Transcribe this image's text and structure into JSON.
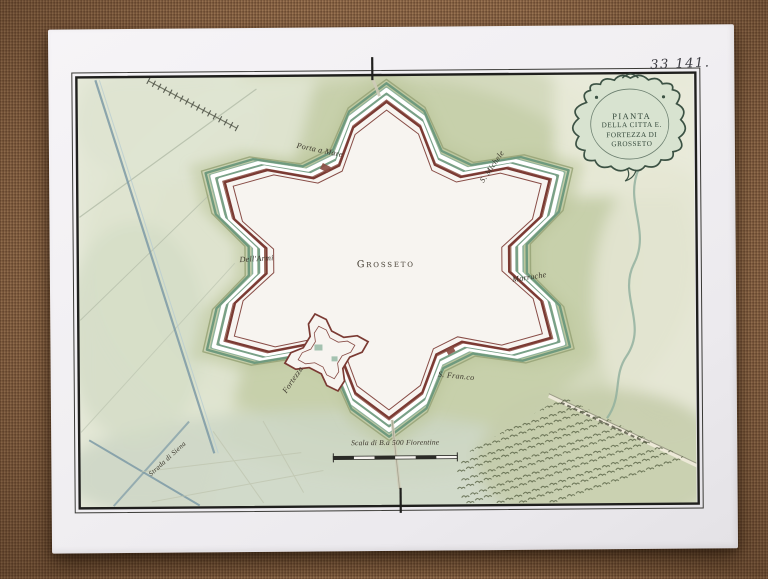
{
  "photo": {
    "fabric_color": "#8d6849",
    "paper_color": "#f2f0f3"
  },
  "map": {
    "sheet_number": "33 141.",
    "cartouche": {
      "lines": [
        "PIANTA",
        "DELLA CITTA E.",
        "FORTEZZA DI",
        "GROSSETO"
      ]
    },
    "labels": {
      "center": "Grosseto",
      "porta_a_mare": "Porta a Mare",
      "s_michele": "S. Michele",
      "dell_armi": "Dell'Armi",
      "marruche": "Marruche",
      "fortezza": "Fortezza",
      "s_francesco": "S. Fran.co",
      "strada": "Strada di Siena"
    },
    "scale_caption": "Scala di B.a 500 Fiorentine",
    "colors": {
      "wall_outline": "#7b3a33",
      "wall_thin": "#8a4a40",
      "rampart_fill": "#f7f4f0",
      "moat_green_dark": "#79a188",
      "moat_green": "#8fb39b",
      "moat_crest": "#6f9a7e",
      "glacis_olive": "#b2bd90",
      "wash_green": "#c0caa0",
      "glacis_line": "#98a478",
      "water_blue": "#7d9aa6",
      "orchard_ink": "#566042",
      "frame_ink": "#1f1f1d",
      "cartouche_fill": "#d8e3d0",
      "cartouche_ink": "#3c5244",
      "teal_accent": "#a4c2b0"
    }
  }
}
